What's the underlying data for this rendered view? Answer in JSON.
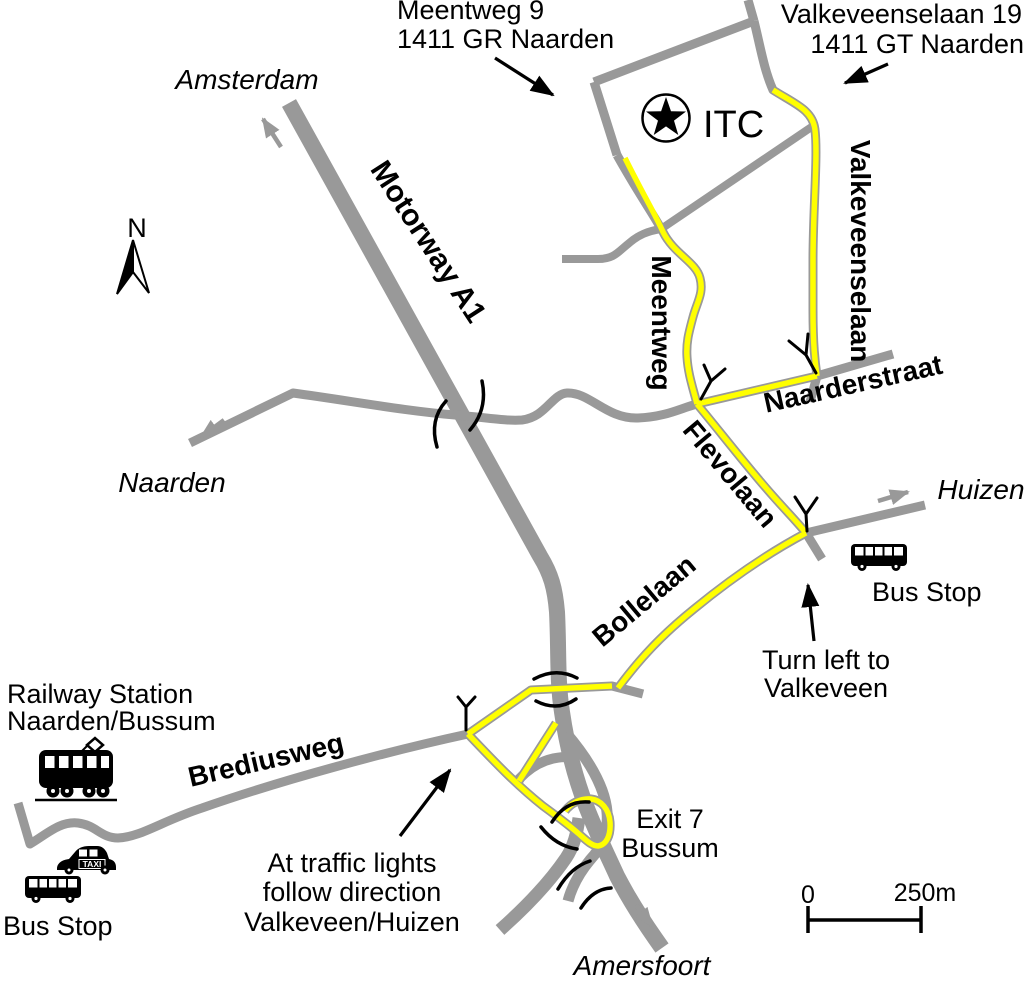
{
  "map_title": "Route map to ITC Naarden",
  "colors": {
    "road": "#999999",
    "route_highlight": "#FFFF00",
    "ink": "#000000",
    "background": "#FFFFFF"
  },
  "destination": {
    "label": "ITC"
  },
  "addresses": {
    "meentweg": {
      "line1": "Meentweg 9",
      "line2": "1411 GR Naarden"
    },
    "valkeveenselaan": {
      "line1": "Valkeveenselaan 19",
      "line2": "1411 GT Naarden"
    }
  },
  "cities": {
    "amsterdam": "Amsterdam",
    "naarden": "Naarden",
    "huizen": "Huizen",
    "amersfoort": "Amersfoort"
  },
  "roads": {
    "motorway": "Motorway A1",
    "meentweg": "Meentweg",
    "valkeveenselaan": "Valkeveenselaan",
    "naarderstraat": "Naarderstraat",
    "flevolaan": "Flevolaan",
    "bollelaan": "Bollelaan",
    "brediusweg": "Brediusweg"
  },
  "annotations": {
    "railway_station": {
      "line1": "Railway Station",
      "line2": "Naarden/Bussum"
    },
    "bus_stop_left": "Bus Stop",
    "bus_stop_right": "Bus Stop",
    "turn_left": {
      "line1": "Turn left to",
      "line2": "Valkeveen"
    },
    "traffic_lights": {
      "line1": "At traffic lights",
      "line2": "follow direction",
      "line3": "Valkeveen/Huizen"
    },
    "exit7": {
      "line1": "Exit 7",
      "line2": "Bussum"
    },
    "taxi": "TAXI"
  },
  "compass": {
    "north": "N"
  },
  "scale": {
    "start": "0",
    "end": "250m"
  },
  "icons": {
    "destination": "star-icon",
    "railway": "tram-icon",
    "taxi": "taxi-icon",
    "bus": "bus-icon",
    "compass": "north-needle-icon",
    "traffic_signal": "traffic-signal-icon",
    "bridge": "bridge-marks-icon"
  }
}
